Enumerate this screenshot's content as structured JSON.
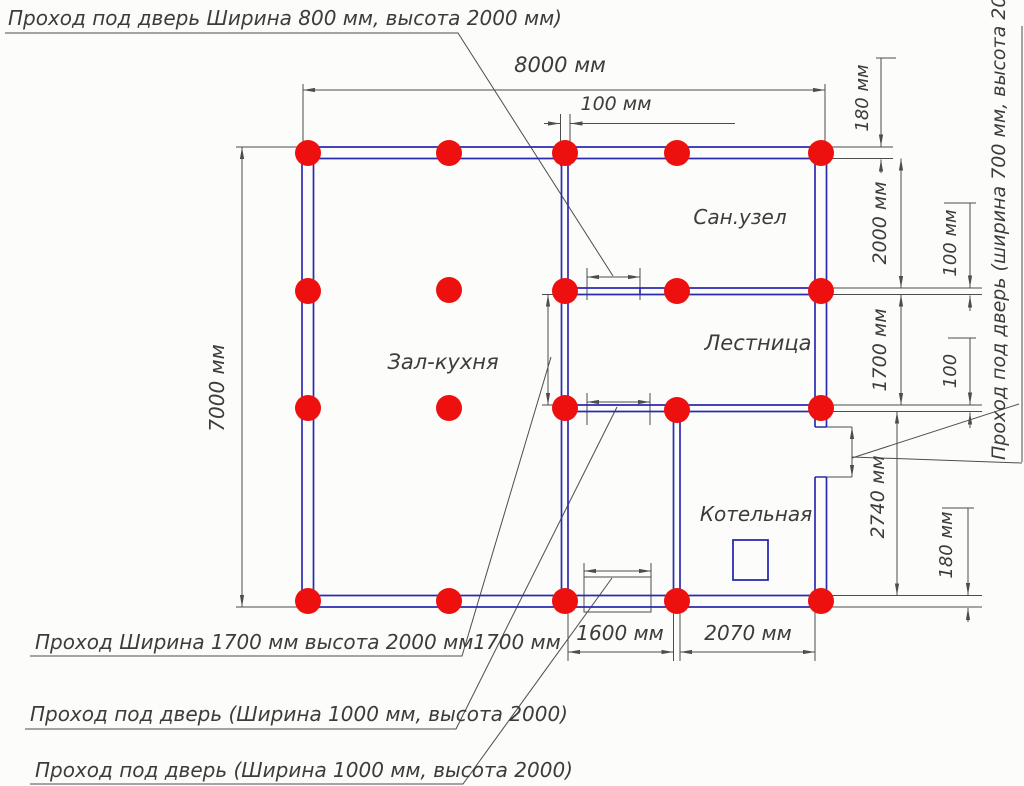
{
  "drawing": {
    "rooms": {
      "hall_kitchen": "Зал-кухня",
      "bathroom": "Сан.узел",
      "stairs": "Лестница",
      "boiler": "Котельная"
    },
    "dims": {
      "width_top": "8000 мм",
      "inner_wall_top": "100 мм",
      "height_left": "7000 мм",
      "right_180_top": "180 мм",
      "right_2000": "2000 мм",
      "right_100_upper": "100 мм",
      "right_1700": "1700 мм",
      "right_100_lower": "100",
      "right_2740": "2740 мм",
      "right_180_bottom": "180 мм",
      "bottom_1600": "1600 мм",
      "bottom_2070": "2070 мм"
    },
    "callouts": {
      "top_left": "Проход под дверь Ширина 800 мм, высота 2000 мм)",
      "right_vertical": "Проход под дверь (ширина 700 мм, высота 2000 мм)",
      "bottom_first": "Проход Ширина 1700 мм высота 2000 мм1700 мм",
      "bottom_second": "Проход под дверь (Ширина 1000 мм, высота 2000)",
      "bottom_third": "Проход под дверь (Ширина 1000 мм, высота 2000)"
    },
    "colors": {
      "wall": "#2b2bb0",
      "pile": "#ee0f0f",
      "line": "#4d4d4d",
      "text": "#3c3c3c",
      "background": "#fcfcfa"
    },
    "piles": {
      "count": 20,
      "radius": 13,
      "positions": [
        [
          308,
          153
        ],
        [
          449,
          153
        ],
        [
          565,
          153
        ],
        [
          677,
          153
        ],
        [
          821,
          153
        ],
        [
          308,
          291
        ],
        [
          449,
          290
        ],
        [
          565,
          291
        ],
        [
          677,
          291
        ],
        [
          821,
          291
        ],
        [
          308,
          408
        ],
        [
          449,
          408
        ],
        [
          565,
          408
        ],
        [
          677,
          410
        ],
        [
          821,
          408
        ],
        [
          308,
          601
        ],
        [
          449,
          601
        ],
        [
          565,
          601
        ],
        [
          677,
          601
        ],
        [
          821,
          601
        ]
      ]
    }
  }
}
